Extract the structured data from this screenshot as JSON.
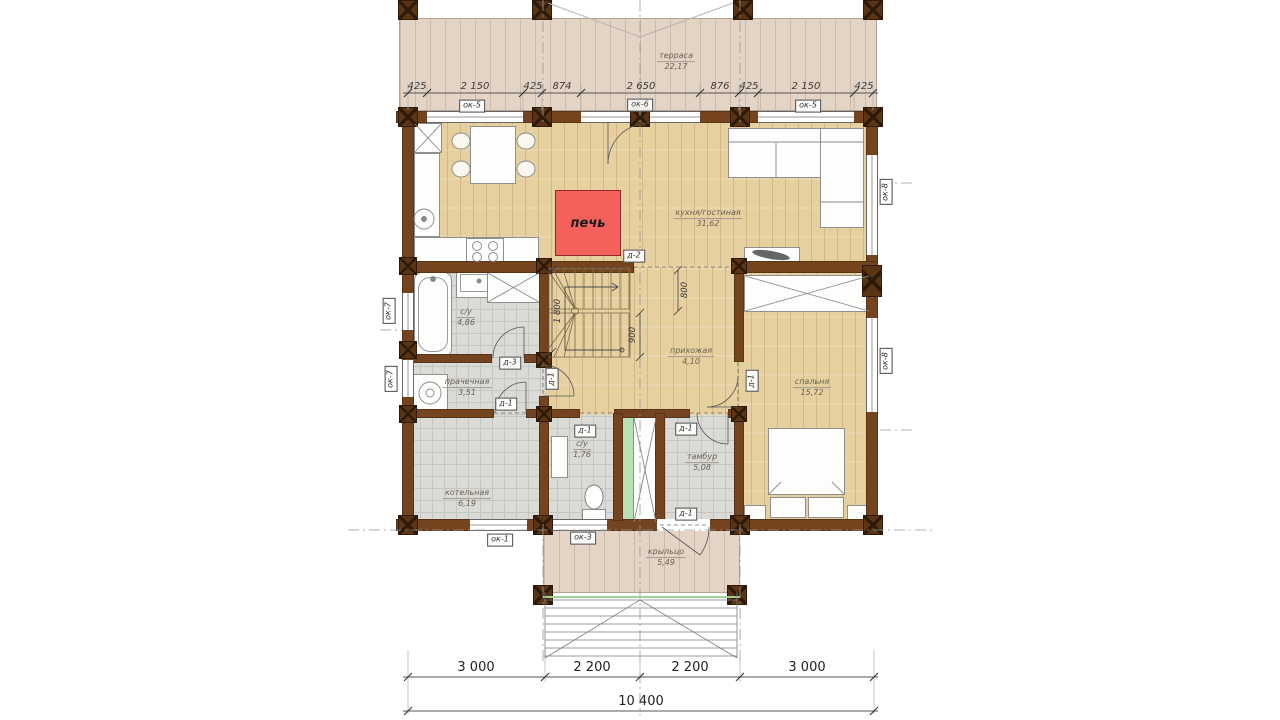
{
  "colors": {
    "wall": "#74441e",
    "post": "#5b3413",
    "post-line": "#2e1a08",
    "floor": "#e6d0a0",
    "floor-line": "#d2b885",
    "deck": "#e4d4c5",
    "deck-line": "#cdb9a6",
    "tile": "#dadad6",
    "tile-line": "#c6c6c0",
    "green": "#b9dfb5",
    "stove": "#f4605c",
    "dim": "#3a3a3a",
    "label": "#6b6257"
  },
  "rooms": {
    "terrace": {
      "name": "терраса",
      "area": "22,17"
    },
    "kitchen_living": {
      "name": "кухня/гостиная",
      "area": "31,62"
    },
    "hallway": {
      "name": "прихожая",
      "area": "4,10"
    },
    "bathroom": {
      "name": "с/у",
      "area": "4,86"
    },
    "laundry": {
      "name": "прачечная",
      "area": "3,51"
    },
    "boiler": {
      "name": "котельная",
      "area": "6,19"
    },
    "wc": {
      "name": "с/у",
      "area": "1,76"
    },
    "tambour": {
      "name": "тамбур",
      "area": "5,08"
    },
    "bedroom": {
      "name": "спальня",
      "area": "15,72"
    },
    "porch": {
      "name": "крыльцо",
      "area": "5,49"
    }
  },
  "stove": {
    "label": "печь"
  },
  "dimensions": {
    "top": [
      "425",
      "2 150",
      "425",
      "874",
      "2 650",
      "876",
      "425",
      "2 150",
      "425"
    ],
    "bottom": [
      "3 000",
      "2 200",
      "2 200",
      "3 000"
    ],
    "total": "10 400",
    "stairs": {
      "flight": "1 800",
      "opening": "800",
      "run": "900"
    }
  },
  "tags": {
    "windows": {
      "top_left": "ок-5",
      "top_center": "ок-6",
      "top_right": "ок-5",
      "left_bath": "ок-7",
      "left_laundry": "ок-7",
      "right_living": "ок-8",
      "right_bedroom": "ок-8",
      "bottom_boiler": "ок-1",
      "bottom_wc": "ок-3"
    },
    "doors": {
      "kitchen": "д-2",
      "bath": "д-3",
      "laundry_boiler": "д-1",
      "laundry_entry": "д-1",
      "bedroom": "д-1",
      "wc": "д-1",
      "tambour_top": "д-1",
      "tambour_exit": "д-1"
    }
  }
}
